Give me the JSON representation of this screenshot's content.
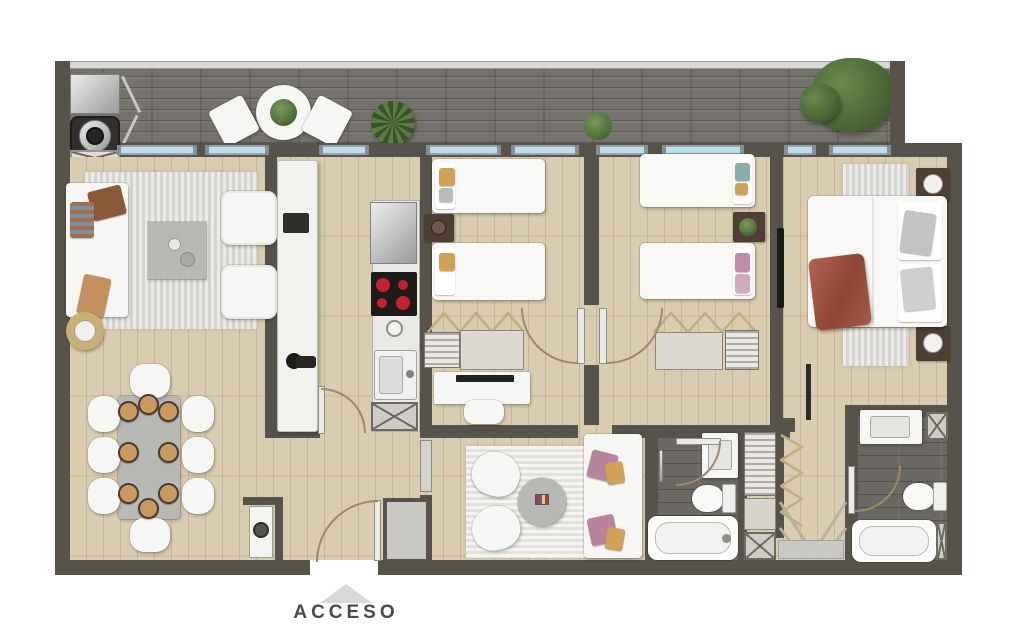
{
  "entry": {
    "label": "ACCESO",
    "arrow_icon": "triangle-up"
  },
  "colors": {
    "wall": "#57534a",
    "terrace_floor": "#75716b",
    "wood": "#d9ccb0",
    "bath_floor": "#6b6762",
    "window_glass": "#bedfee",
    "window_frame": "#98a3a9",
    "rug": "#dcdbd7",
    "rug_family": "#eceae5",
    "white_furniture": "#f6f6f4",
    "gray_table": "#b8b9b5",
    "dark_wood": "#4f3e34",
    "tan": "#c89a62",
    "terracotta": "#a85a48",
    "pink": "#c08ba8",
    "teal": "#8aacaa",
    "door_arc": "#9c8a6a",
    "text": "#4a4a4a",
    "arrow": "#d9d9d9"
  }
}
